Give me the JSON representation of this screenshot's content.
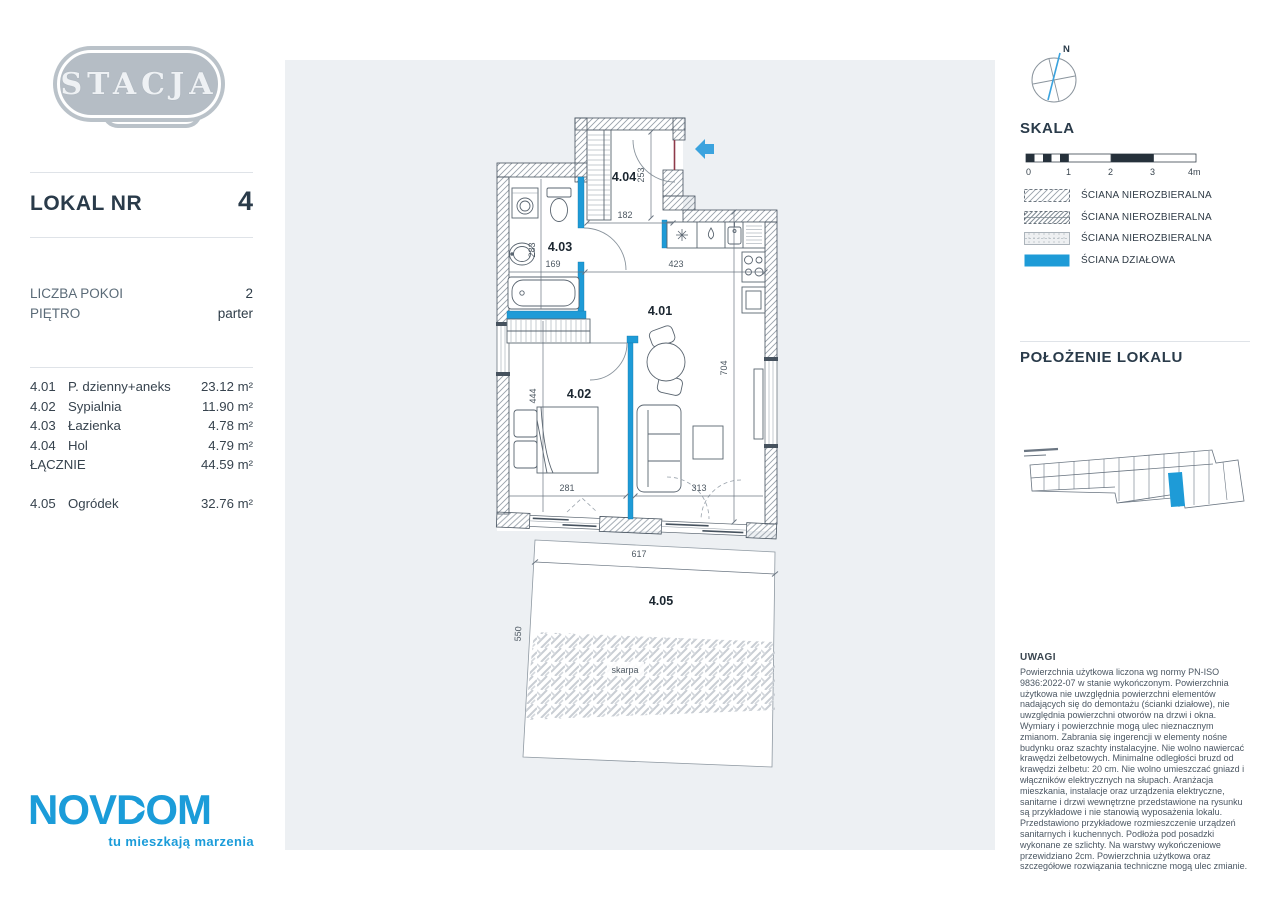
{
  "branding": {
    "project_name": "STACJA",
    "project_subtitle": "GRODZISK",
    "developer_name": "NOVDOM",
    "developer_tagline": "tu mieszkają marzenia",
    "brand_blue": "#1b9cd9"
  },
  "header": {
    "unit_label": "LOKAL NR",
    "unit_number": "4"
  },
  "details": {
    "rows": [
      {
        "label": "LICZBA POKOI",
        "value": "2"
      },
      {
        "label": "PIĘTRO",
        "value": "parter"
      }
    ]
  },
  "rooms": {
    "items": [
      {
        "no": "4.01",
        "name": "P. dzienny+aneks",
        "area": "23.12 m²"
      },
      {
        "no": "4.02",
        "name": "Sypialnia",
        "area": "11.90 m²"
      },
      {
        "no": "4.03",
        "name": "Łazienka",
        "area": "4.78 m²"
      },
      {
        "no": "4.04",
        "name": "Hol",
        "area": "4.79 m²"
      }
    ],
    "total": {
      "label": "ŁĄCZNIE",
      "area": "44.59 m²"
    },
    "extra": {
      "no": "4.05",
      "name": "Ogródek",
      "area": "32.76 m²"
    }
  },
  "compass": {
    "north_label": "N"
  },
  "scale": {
    "title": "SKALA",
    "ticks": [
      "0",
      "1",
      "2",
      "3",
      "4m"
    ]
  },
  "legend": {
    "items": [
      {
        "type": "hatch-sparse",
        "label": "ŚCIANA NIEROZBIERALNA"
      },
      {
        "type": "hatch-dense",
        "label": "ŚCIANA NIEROZBIERALNA"
      },
      {
        "type": "dashed-light",
        "label": "ŚCIANA NIEROZBIERALNA"
      },
      {
        "type": "solid-blue",
        "label": "ŚCIANA DZIAŁOWA"
      }
    ]
  },
  "location": {
    "title": "POŁOŻENIE LOKALU"
  },
  "notes": {
    "title": "UWAGI",
    "body": "Powierzchnia użytkowa liczona wg normy PN-ISO 9836:2022-07 w stanie wykończonym. Powierzchnia użytkowa nie uwzględnia powierzchni elementów nadających się do demontażu (ścianki działowe), nie uwzględnia powierzchni otworów na drzwi i okna. Wymiary i powierzchnie mogą ulec nieznacznym zmianom. Zabrania się ingerencji w elementy nośne budynku oraz szachty instalacyjne. Nie wolno nawiercać krawędzi żelbetowych. Minimalne odległości bruzd od krawędzi żelbetu: 20 cm. Nie wolno umieszczać gniazd i włączników elektrycznych na słupach. Aranżacja mieszkania, instalacje oraz urządzenia elektryczne, sanitarne i drzwi wewnętrzne przedstawione na rysunku są przykładowe i nie stanowią wyposażenia lokalu. Przedstawiono przykładowe rozmieszczenie urządzeń sanitarnych i kuchennych. Podłoża pod posadzki wykonane ze szlichty. Na warstwy wykończeniowe przewidziano 2cm. Powierzchnia użytkowa oraz szczegółowe rozwiązania techniczne mogą ulec zmianie."
  },
  "plan": {
    "labels": {
      "living": "4.01",
      "bedroom": "4.02",
      "bathroom": "4.03",
      "hall": "4.04",
      "garden": "4.05",
      "skarpa": "skarpa"
    },
    "dims": {
      "hall_h": "253",
      "hall_w": "182",
      "bath_h": "283",
      "bath_w": "169",
      "kitchen_w": "423",
      "living_h": "704",
      "bedroom_h": "444",
      "bedroom_w": "281",
      "sofa_w": "313",
      "garden_w": "617",
      "garden_h": "550"
    }
  }
}
